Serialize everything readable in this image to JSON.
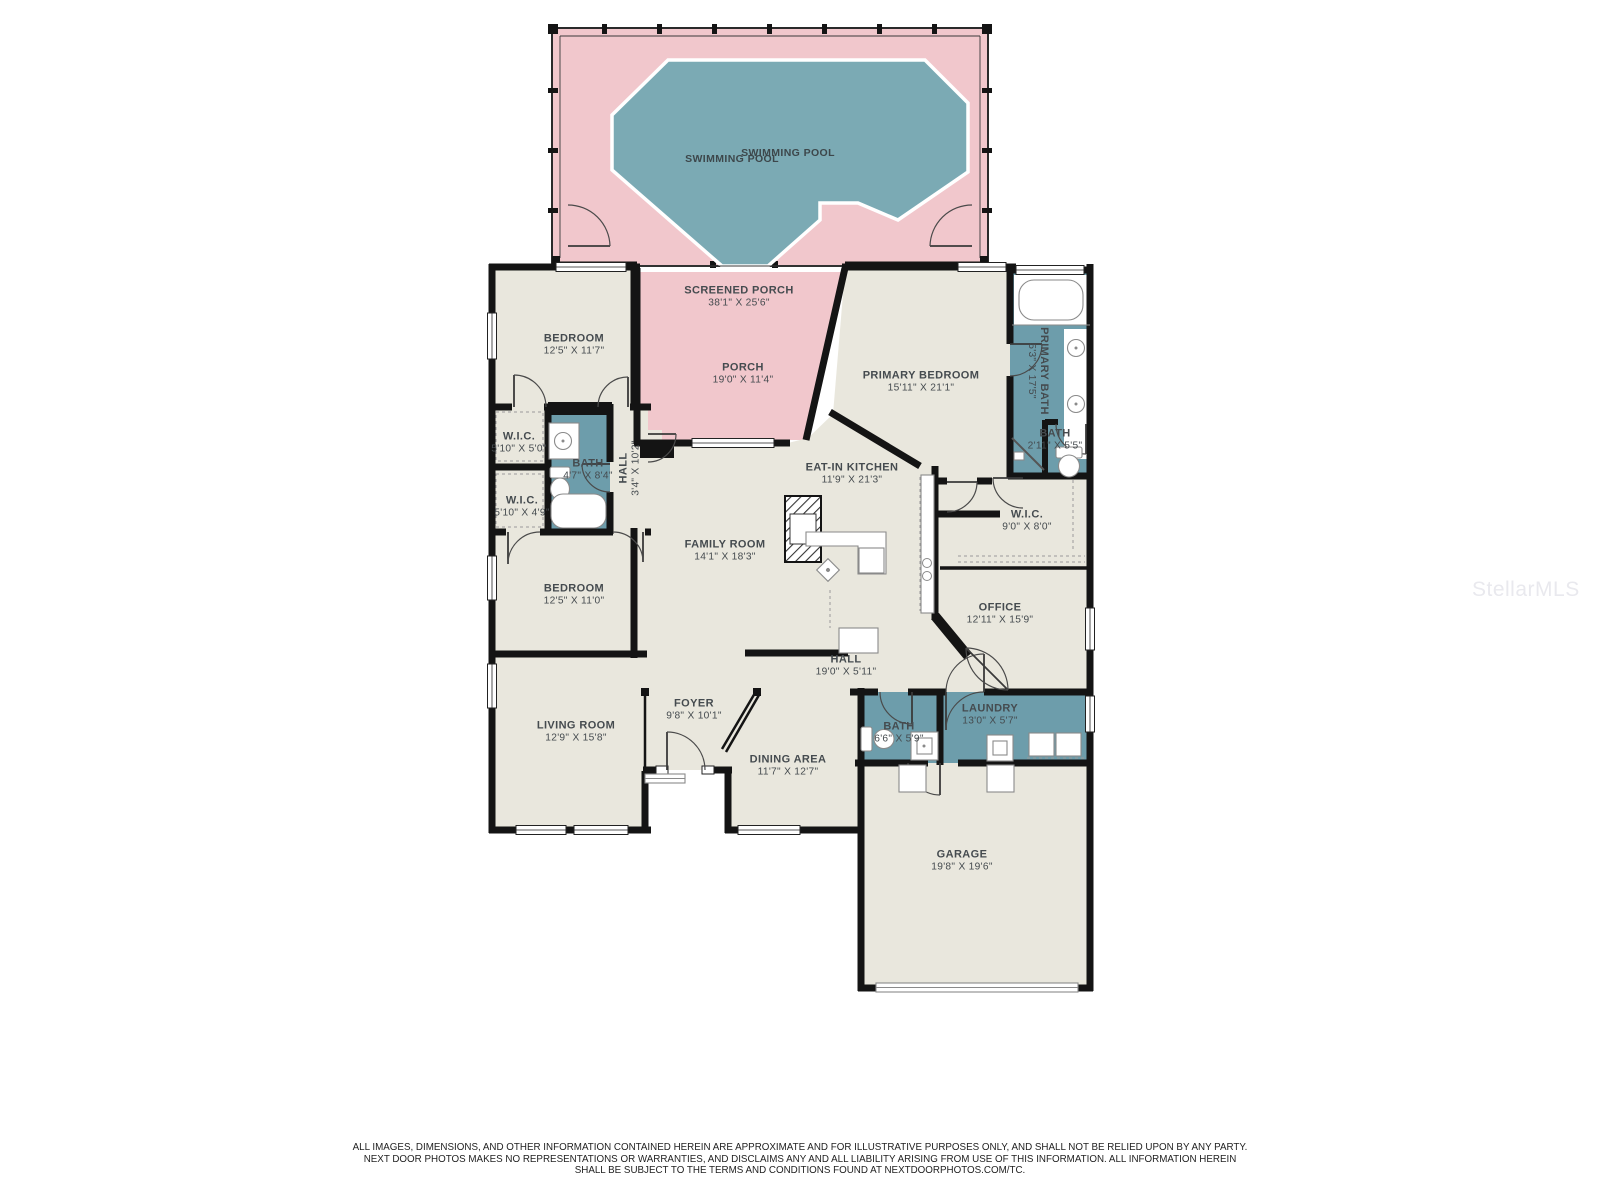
{
  "watermark": "StellarMLS",
  "disclaimer": {
    "line1": "ALL IMAGES, DIMENSIONS, AND OTHER INFORMATION CONTAINED HEREIN ARE APPROXIMATE AND FOR ILLUSTRATIVE PURPOSES ONLY, AND SHALL NOT BE RELIED UPON BY ANY PARTY.",
    "line2": "NEXT DOOR PHOTOS MAKES NO REPRESENTATIONS OR WARRANTIES, AND DISCLAIMS ANY AND ALL LIABILITY ARISING FROM USE OF THIS INFORMATION. ALL INFORMATION HEREIN",
    "line3": "SHALL BE SUBJECT TO THE TERMS AND CONDITIONS FOUND AT NEXTDOORPHOTOS.COM/TC."
  },
  "colors": {
    "room_fill": "#e9e7dd",
    "porch_fill": "#f1c7cc",
    "pool_fill": "#7baab4",
    "bath_fill": "#6d9dab",
    "wall": "#141414",
    "label_text": "#454b4f"
  },
  "rooms": [
    {
      "name": "SWIMMING POOL",
      "dims": ""
    },
    {
      "name": "SWIMMING POOL",
      "dims": ""
    },
    {
      "name": "SCREENED PORCH",
      "dims": "38'1\" X 25'6\""
    },
    {
      "name": "PORCH",
      "dims": "19'0\" X 11'4\""
    },
    {
      "name": "BEDROOM",
      "dims": "12'5\" X 11'7\""
    },
    {
      "name": "W.I.C.",
      "dims": "5'10\" X 5'0\""
    },
    {
      "name": "BATH",
      "dims": "4'7\" X 8'4\""
    },
    {
      "name": "W.I.C.",
      "dims": "5'10\" X 4'9\""
    },
    {
      "name": "HALL",
      "dims": "3'4\" X 10'2\""
    },
    {
      "name": "BEDROOM",
      "dims": "12'5\" X 11'0\""
    },
    {
      "name": "FAMILY ROOM",
      "dims": "14'1\" X 18'3\""
    },
    {
      "name": "LIVING ROOM",
      "dims": "12'9\" X 15'8\""
    },
    {
      "name": "FOYER",
      "dims": "9'8\" X 10'1\""
    },
    {
      "name": "DINING AREA",
      "dims": "11'7\" X 12'7\""
    },
    {
      "name": "EAT-IN KITCHEN",
      "dims": "11'9\" X 21'3\""
    },
    {
      "name": "PRIMARY BEDROOM",
      "dims": "15'11\" X 21'1\""
    },
    {
      "name": "PRIMARY BATH",
      "dims": "5'3\" X 17'5\""
    },
    {
      "name": "BATH",
      "dims": "2'11\" X 5'5\""
    },
    {
      "name": "W.I.C.",
      "dims": "9'0\" X 8'0\""
    },
    {
      "name": "OFFICE",
      "dims": "12'11\" X 15'9\""
    },
    {
      "name": "HALL",
      "dims": "19'0\" X 5'11\""
    },
    {
      "name": "BATH",
      "dims": "6'6\" X 5'9\""
    },
    {
      "name": "LAUNDRY",
      "dims": "13'0\" X 5'7\""
    },
    {
      "name": "GARAGE",
      "dims": "19'8\" X 19'6\""
    }
  ]
}
